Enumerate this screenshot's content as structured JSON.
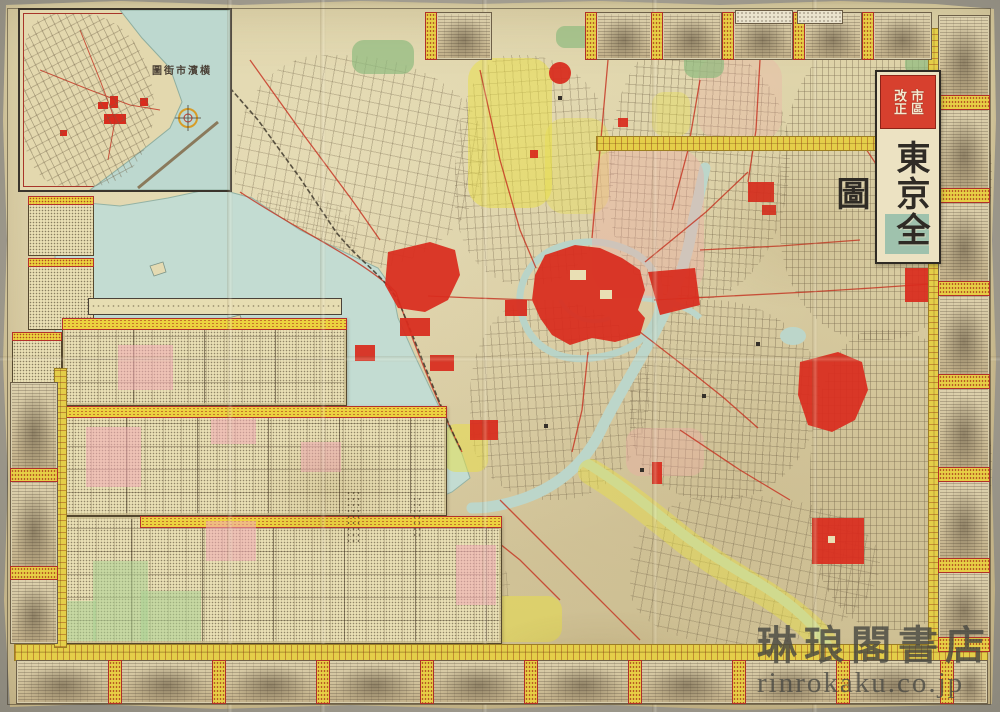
{
  "colors": {
    "paper": "#dcd1a6",
    "band_yellow": "#e4ce49",
    "landmark_red": "#d92c1e",
    "water_blue": "#c3dcd2",
    "backdrop_gray": "#a9a599"
  },
  "title_cartouche": {
    "top_right_col": "市區",
    "top_left_col": "改正",
    "title_vertical": "東京全圖"
  },
  "inset": {
    "title_rtl": "圖街市濱横"
  },
  "watermark": {
    "shop": "琳琅閣書店",
    "domain": "rinrokaku.co.jp"
  }
}
